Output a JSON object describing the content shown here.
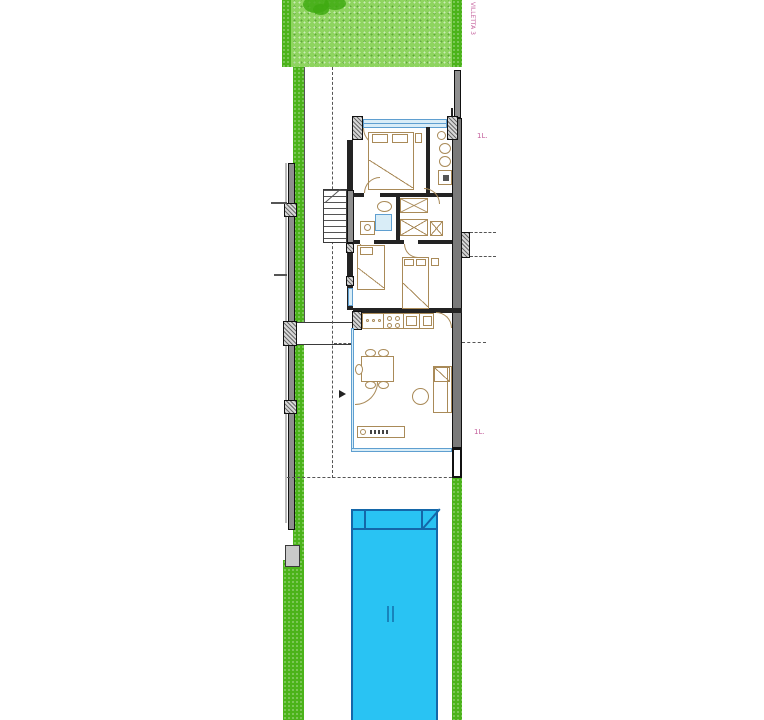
{
  "title": "Villa site floor plan",
  "labels": {
    "site_vertical": "VILLETTA 3",
    "level_upper": "1L.",
    "level_lower": "1L."
  },
  "colors": {
    "lawn": "#8ed45f",
    "lawn_edge": "#4bb31a",
    "pool": "#29c3f3",
    "pool_line": "#1467a9",
    "wall_gray": "#8f8f8f",
    "wall_dark": "#232323",
    "furniture": "#a98a58",
    "glass": "#5f9fd0",
    "glass_fill": "#d9edf7",
    "label_pink": "#c4609c"
  }
}
